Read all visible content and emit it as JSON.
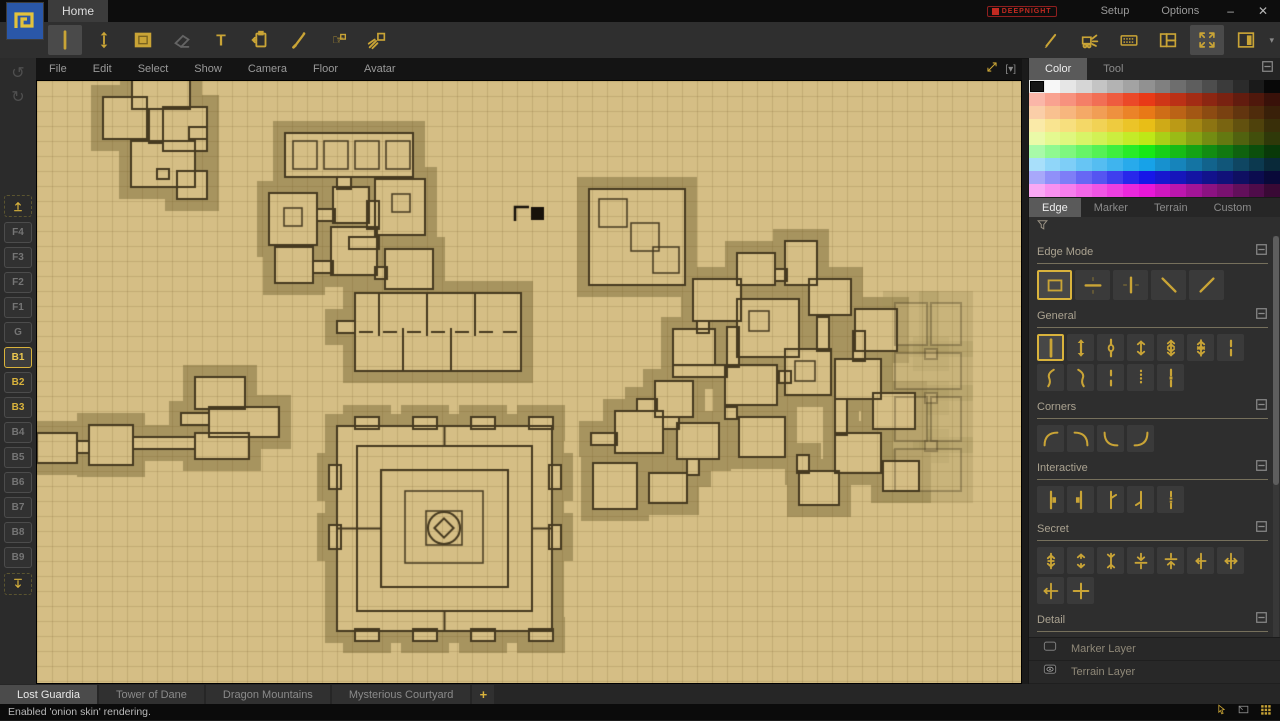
{
  "titlebar": {
    "home_tab": "Home",
    "brand": "DEEPNIGHT",
    "setup": "Setup",
    "options": "Options",
    "minimize": "–",
    "close": "✕"
  },
  "toolbar": {
    "left": [
      {
        "name": "wall-tool",
        "icon": "vline",
        "selected": true
      },
      {
        "name": "edge-arrows-tool",
        "icon": "varrows"
      },
      {
        "name": "terrain-fill-tool",
        "icon": "filled-square"
      },
      {
        "name": "eraser-tool",
        "icon": "eraser",
        "disabled": true
      },
      {
        "name": "text-tool",
        "icon": "text"
      },
      {
        "name": "stamp-tool",
        "icon": "clipboard"
      },
      {
        "name": "pen-tool",
        "icon": "pen"
      },
      {
        "name": "avatar-hand-tool",
        "icon": "hand"
      },
      {
        "name": "light-rays-tool",
        "icon": "rays"
      }
    ],
    "right": [
      {
        "name": "brush-tool",
        "icon": "brush"
      },
      {
        "name": "bulldoze-tool",
        "icon": "bulldozer"
      },
      {
        "name": "shortcuts-tool",
        "icon": "keyboard"
      },
      {
        "name": "layout-panels-tool",
        "icon": "panels"
      },
      {
        "name": "fullscreen-tool",
        "icon": "fullscreen",
        "selected": true
      },
      {
        "name": "side-panel-tool",
        "icon": "sidebar"
      }
    ],
    "dropdown_arrow": "▾"
  },
  "menubar": {
    "items": [
      "File",
      "Edit",
      "Select",
      "Show",
      "Camera",
      "Floor",
      "Avatar"
    ],
    "dropdown": "[▾]"
  },
  "sidebar": {
    "undo": "↺",
    "redo": "↻",
    "floors": [
      "F4",
      "F3",
      "F2",
      "F1",
      "G",
      "B1",
      "B2",
      "B3",
      "B4",
      "B5",
      "B6",
      "B7",
      "B8",
      "B9"
    ],
    "active_floor": "B1",
    "onion_floors": [
      "B2",
      "B3"
    ]
  },
  "right_panel": {
    "top_tabs": [
      {
        "label": "Color",
        "active": true
      },
      {
        "label": "Tool",
        "active": false
      }
    ],
    "palette": {
      "rows": 9,
      "cols": 16,
      "selected_row": 0,
      "selected_col": 0,
      "row_hues": [
        -1,
        10,
        28,
        48,
        72,
        120,
        200,
        240,
        305
      ]
    },
    "category_tabs": [
      {
        "label": "Edge",
        "active": true
      },
      {
        "label": "Marker",
        "active": false
      },
      {
        "label": "Terrain",
        "active": false
      },
      {
        "label": "Custom",
        "active": false
      }
    ],
    "sections": [
      {
        "title": "Edge Mode",
        "size": "lg",
        "selected": 0,
        "buttons": [
          "mode-rect",
          "mode-horizontal",
          "mode-vertical",
          "mode-diagonal-back",
          "mode-diagonal-forward"
        ]
      },
      {
        "title": "General",
        "selected": 0,
        "buttons": [
          "wall",
          "wall-end-arrows",
          "wall-door",
          "wall-arrows",
          "wall-double-arrows",
          "wall-triple-arrows",
          "wall-dash-mid",
          "curve-hook-right",
          "curve-hook-left",
          "wall-dashed-short",
          "wall-dotted",
          "wall-dash-square"
        ]
      },
      {
        "title": "Corners",
        "selected": -1,
        "buttons": [
          "arc-top-left",
          "arc-top-right",
          "arc-bottom-left",
          "arc-bottom-right"
        ]
      },
      {
        "title": "Interactive",
        "selected": -1,
        "buttons": [
          "door-right",
          "door-left",
          "door-swing-right",
          "door-swing-left",
          "door-double"
        ]
      },
      {
        "title": "Secret",
        "selected": -1,
        "buttons": [
          "secret-arrows-vertical",
          "secret-dashed-arrows",
          "secret-arrows-inward",
          "secret-arrows-down-line",
          "secret-arrows-up-line",
          "secret-arrows-left-line",
          "secret-arrows-both-line",
          "secret-arrow-left-cross",
          "secret-cross"
        ]
      },
      {
        "title": "Detail",
        "selected": -1,
        "buttons": [
          "detail-thick",
          "detail-tick",
          "detail-double-tick"
        ]
      },
      {
        "title": "Half",
        "selected": -1,
        "buttons": [
          "half-line",
          "half-short",
          "half-corner",
          "half-arrow"
        ]
      }
    ],
    "layers": [
      {
        "label": "Marker Layer",
        "icon": "empty-box"
      },
      {
        "label": "Terrain Layer",
        "icon": "eye"
      }
    ]
  },
  "map_tabs": {
    "tabs": [
      {
        "label": "Lost Guardia",
        "active": true
      },
      {
        "label": "Tower of Dane",
        "active": false
      },
      {
        "label": "Dragon Mountains",
        "active": false
      },
      {
        "label": "Mysterious Courtyard",
        "active": false
      }
    ],
    "add_label": "+"
  },
  "statusbar": {
    "message": "Enabled 'onion skin' rendering."
  },
  "map": {
    "grid": 15,
    "colors": {
      "floor": "#d5be85",
      "halo": "#a7945f",
      "wall": "#463a20",
      "grid": "rgba(105,80,30,0.16)",
      "cursor": "#17110a"
    },
    "cursor": {
      "x": 478,
      "y": 124
    },
    "clusters": [
      {
        "name": "northwest-warren",
        "alpha": 1,
        "rooms": [
          [
            95,
            -8,
            58,
            36
          ],
          [
            66,
            16,
            44,
            42
          ],
          [
            126,
            26,
            44,
            44
          ],
          [
            94,
            60,
            64,
            46
          ],
          [
            140,
            90,
            30,
            28
          ]
        ],
        "corridors": [
          [
            112,
            28,
            14,
            34
          ],
          [
            152,
            46,
            18,
            12
          ],
          [
            120,
            88,
            12,
            10
          ]
        ],
        "subrooms": []
      },
      {
        "name": "great-hall-complex",
        "alpha": 1,
        "rooms": [
          [
            248,
            52,
            128,
            44
          ],
          [
            232,
            112,
            48,
            52
          ],
          [
            296,
            106,
            36,
            36
          ],
          [
            338,
            98,
            50,
            56
          ],
          [
            238,
            166,
            38,
            36
          ],
          [
            294,
            146,
            46,
            48
          ],
          [
            348,
            168,
            48,
            40
          ]
        ],
        "corridors": [
          [
            300,
            96,
            14,
            12
          ],
          [
            280,
            128,
            18,
            12
          ],
          [
            312,
            156,
            30,
            12
          ],
          [
            330,
            120,
            12,
            28
          ],
          [
            276,
            180,
            20,
            12
          ],
          [
            338,
            186,
            12,
            12
          ]
        ],
        "subrooms": [
          [
            256,
            60,
            24,
            28
          ],
          [
            287,
            60,
            24,
            28
          ],
          [
            318,
            60,
            24,
            28
          ],
          [
            349,
            60,
            24,
            28
          ],
          [
            247,
            127,
            18,
            18
          ],
          [
            355,
            113,
            18,
            18
          ]
        ]
      },
      {
        "name": "barracks-block",
        "alpha": 1,
        "maze": "barracks",
        "rooms": [
          [
            318,
            212,
            166,
            78
          ]
        ],
        "corridors": [
          [
            300,
            240,
            18,
            12
          ]
        ],
        "subrooms": []
      },
      {
        "name": "west-annex",
        "alpha": 1,
        "rooms": [
          [
            158,
            296,
            50,
            32
          ],
          [
            172,
            326,
            70,
            30
          ],
          [
            158,
            352,
            54,
            26
          ]
        ],
        "corridors": [
          [
            144,
            332,
            28,
            12
          ]
        ],
        "subrooms": []
      },
      {
        "name": "west-passage",
        "alpha": 1,
        "rooms": [
          [
            0,
            352,
            40,
            30
          ],
          [
            52,
            344,
            44,
            40
          ]
        ],
        "corridors": [
          [
            40,
            360,
            12,
            12
          ],
          [
            96,
            356,
            62,
            12
          ]
        ],
        "subrooms": []
      },
      {
        "name": "citadel",
        "alpha": 1,
        "maze": "castle",
        "circle": [
          407,
          447,
          16
        ],
        "rooms": [
          [
            300,
            345,
            215,
            205
          ]
        ],
        "corridors": [
          [
            318,
            336,
            24,
            12
          ],
          [
            376,
            336,
            24,
            12
          ],
          [
            434,
            336,
            24,
            12
          ],
          [
            492,
            336,
            24,
            12
          ],
          [
            318,
            548,
            24,
            12
          ],
          [
            376,
            548,
            24,
            12
          ],
          [
            434,
            548,
            24,
            12
          ],
          [
            492,
            548,
            24,
            12
          ],
          [
            292,
            384,
            12,
            24
          ],
          [
            292,
            444,
            12,
            24
          ],
          [
            512,
            384,
            12,
            24
          ],
          [
            512,
            444,
            12,
            24
          ]
        ],
        "subrooms": [
          [
            368,
            410,
            78,
            72
          ],
          [
            389,
            430,
            36,
            34
          ]
        ]
      },
      {
        "name": "spiral-vault",
        "alpha": 1,
        "rooms": [
          [
            552,
            108,
            96,
            96
          ]
        ],
        "corridors": [],
        "subrooms": [
          [
            562,
            118,
            28,
            28
          ],
          [
            594,
            142,
            28,
            28
          ],
          [
            616,
            166,
            26,
            26
          ]
        ]
      },
      {
        "name": "east-sprawl",
        "alpha": 1,
        "rooms": [
          [
            700,
            172,
            38,
            32
          ],
          [
            748,
            160,
            32,
            44
          ],
          [
            656,
            198,
            48,
            42
          ],
          [
            700,
            218,
            62,
            58
          ],
          [
            772,
            198,
            42,
            36
          ],
          [
            636,
            248,
            42,
            36
          ],
          [
            688,
            284,
            52,
            40
          ],
          [
            748,
            268,
            46,
            46
          ],
          [
            618,
            300,
            38,
            36
          ],
          [
            578,
            330,
            48,
            42
          ],
          [
            640,
            342,
            42,
            36
          ],
          [
            702,
            336,
            46,
            40
          ],
          [
            556,
            382,
            44,
            46
          ],
          [
            612,
            392,
            38,
            30
          ],
          [
            818,
            228,
            42,
            42
          ],
          [
            798,
            278,
            46,
            40
          ],
          [
            836,
            312,
            42,
            36
          ],
          [
            798,
            352,
            46,
            40
          ],
          [
            846,
            380,
            36,
            30
          ],
          [
            762,
            390,
            40,
            34
          ]
        ],
        "corridors": [
          [
            738,
            188,
            12,
            12
          ],
          [
            690,
            246,
            12,
            40
          ],
          [
            780,
            236,
            12,
            34
          ],
          [
            660,
            240,
            12,
            12
          ],
          [
            636,
            284,
            54,
            12
          ],
          [
            600,
            318,
            20,
            12
          ],
          [
            626,
            336,
            16,
            12
          ],
          [
            554,
            352,
            26,
            12
          ],
          [
            688,
            326,
            12,
            12
          ],
          [
            742,
            290,
            12,
            12
          ],
          [
            816,
            250,
            12,
            30
          ],
          [
            798,
            318,
            12,
            36
          ],
          [
            760,
            374,
            12,
            18
          ],
          [
            650,
            378,
            12,
            16
          ]
        ],
        "subrooms": [
          [
            712,
            230,
            20,
            20
          ],
          [
            758,
            280,
            20,
            20
          ]
        ]
      },
      {
        "name": "onion-skin-floor",
        "alpha": 0.35,
        "rooms": [
          [
            858,
            222,
            32,
            42
          ],
          [
            894,
            222,
            30,
            42
          ],
          [
            858,
            272,
            66,
            36
          ],
          [
            858,
            316,
            32,
            44
          ],
          [
            894,
            316,
            30,
            44
          ],
          [
            858,
            368,
            66,
            42
          ]
        ],
        "corridors": [
          [
            888,
            268,
            12,
            10
          ],
          [
            888,
            312,
            12,
            10
          ],
          [
            888,
            360,
            12,
            10
          ]
        ],
        "subrooms": []
      }
    ]
  }
}
